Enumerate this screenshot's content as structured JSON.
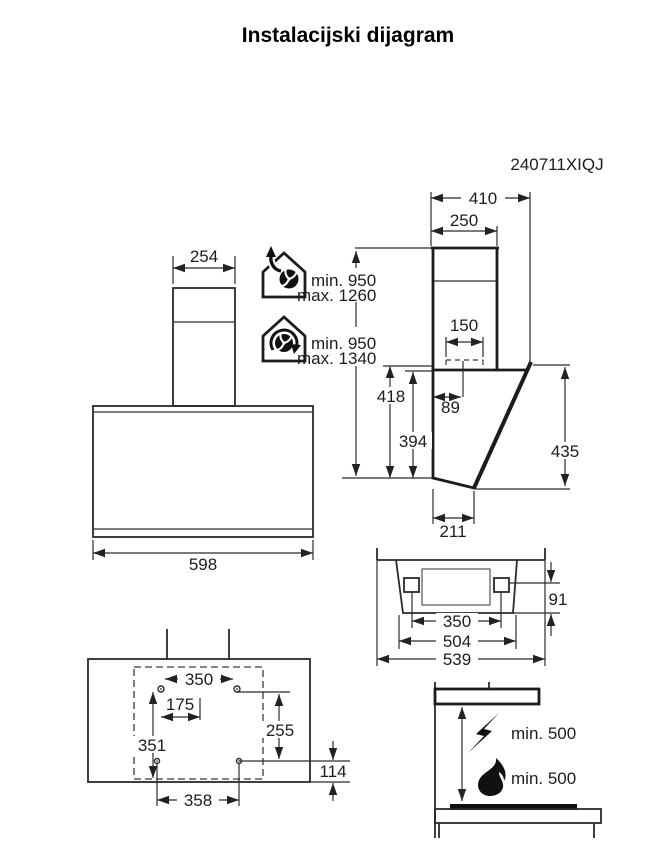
{
  "page": {
    "title": "Instalacijski dijagram",
    "model": "240711XIQJ"
  },
  "front_view": {
    "chimney_width": "254",
    "body_width": "598"
  },
  "side_view": {
    "overall_depth": "410",
    "chimney_depth": "250",
    "duct_width": "150",
    "duct_offset": "89",
    "front_height": "418",
    "back_height": "394",
    "panel_height": "435",
    "bottom_depth": "211"
  },
  "mounting_height": {
    "exhaust": {
      "icon": "house-exhaust-fan-icon",
      "min": "min. 950",
      "max": "max. 1260"
    },
    "recirculation": {
      "icon": "house-recirculation-fan-icon",
      "min": "min. 950",
      "max": "max. 1340"
    }
  },
  "top_view": {
    "bracket_spacing": "350",
    "inner_width": "504",
    "overall_width": "539",
    "bracket_depth": "91"
  },
  "drilling_template": {
    "upper_hole_spacing": "350",
    "center_offset": "175",
    "left_height": "351",
    "right_height": "255",
    "lower_edge_offset": "114",
    "lower_hole_spacing": "358"
  },
  "clearances": {
    "electric_hob": {
      "icon": "lightning-icon",
      "label": "min. 500"
    },
    "gas_hob": {
      "icon": "flame-icon",
      "label": "min. 500"
    }
  }
}
